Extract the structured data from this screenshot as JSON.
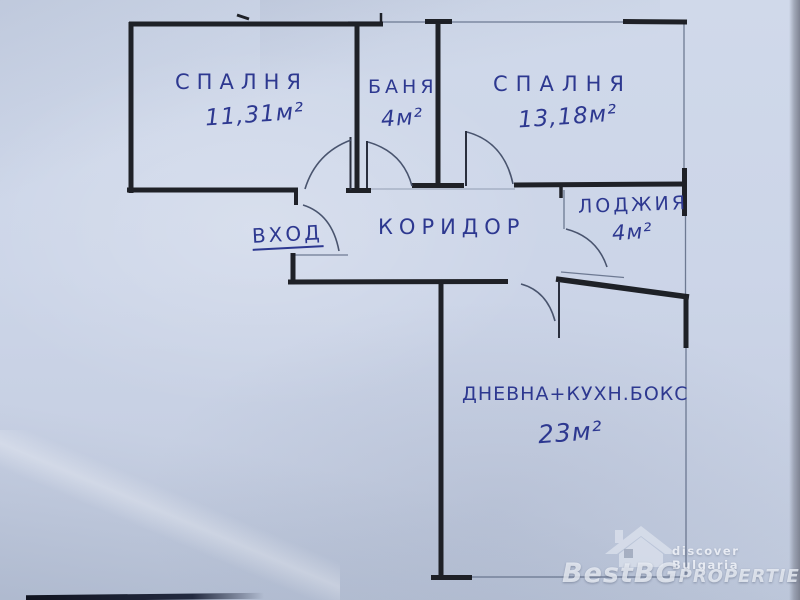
{
  "plan": {
    "rooms": [
      {
        "id": "bedroom-1",
        "name": "СПАЛНЯ",
        "area": "11,31м²"
      },
      {
        "id": "bathroom",
        "name": "БАНЯ",
        "area": "4м²"
      },
      {
        "id": "bedroom-2",
        "name": "СПАЛНЯ",
        "area": "13,18м²"
      },
      {
        "id": "loggia",
        "name": "ЛОДЖИЯ",
        "area": "4м²"
      },
      {
        "id": "living-kitchen",
        "name": "ДНЕВНА+КУХН.БОКС",
        "area": "23м²"
      }
    ],
    "corridor_label": "КОРИДОР",
    "entrance_label": "ВХОД"
  },
  "watermark": {
    "tagline": "discover Bulgaria",
    "brand": "BestBGProperties",
    "brand_parts": {
      "p1": "Best",
      "p2": "BG",
      "p3": "Properties"
    }
  },
  "colors": {
    "paper": "#ccd5e8",
    "ink_blue": "#2d3890",
    "pen_black": "#181a20",
    "pencil_gray": "#5d6a84",
    "watermark_white": "#eef2f9"
  }
}
